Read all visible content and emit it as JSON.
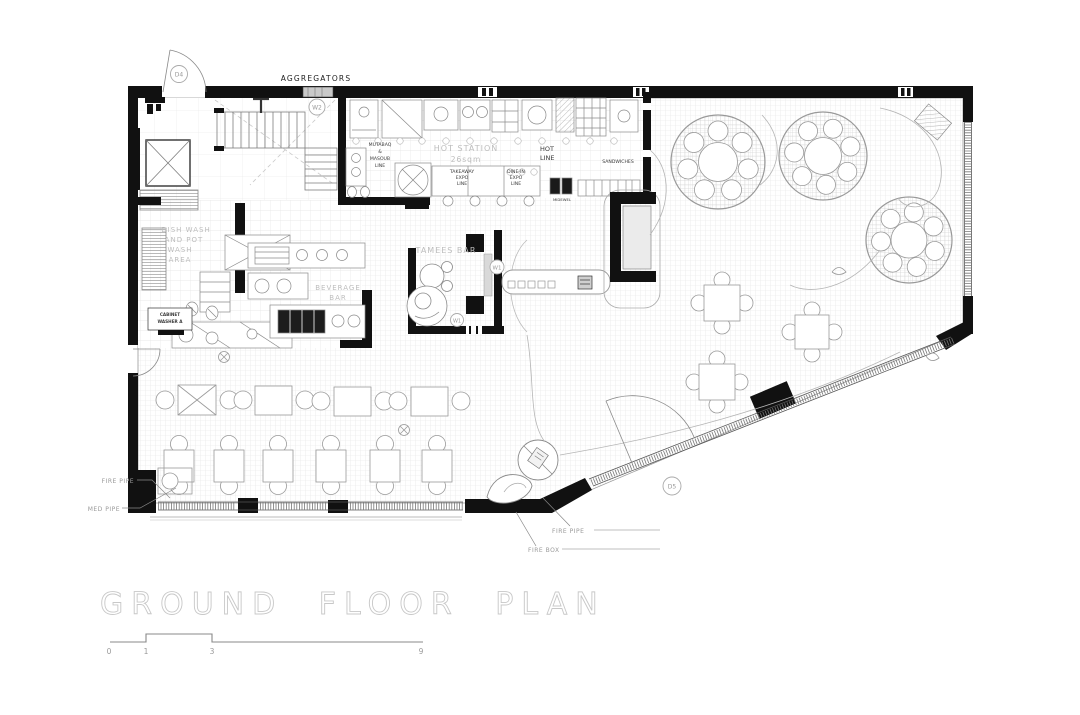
{
  "title": "GROUND FLOOR PLAN",
  "colors": {
    "wall": "#111111",
    "furniture_line": "#8a8a8a",
    "area_label": "#bdbdbd",
    "title_outline": "#c8c8c8",
    "window_gray": "#c9c9c9"
  },
  "labels": {
    "aggregators": "AGGREGATORS",
    "hot_station": "HOT STATION",
    "hot_station_area": "26sqm",
    "hot_line": [
      "HOT",
      "LINE"
    ],
    "takeaway_expo": [
      "TAKEAWAY",
      "EXPO",
      "LINE"
    ],
    "dinein_expo": [
      "DINE-IN",
      "EXPO",
      "LINE"
    ],
    "sandwiches": "SANDWICHES",
    "midewel": "MIDEWEL",
    "mutabaq_line": [
      "MUTABAQ",
      "&",
      "MASOUB",
      "LINE"
    ],
    "tamees_bar": "TAMEES BAR",
    "dish_wash": [
      "DISH WASH",
      "AND POT",
      "WASH",
      "AREA"
    ],
    "beverage_bar": [
      "BEVERAGE",
      "BAR"
    ],
    "cabinet": [
      "CABINET",
      "WASHER A"
    ],
    "fire_pipe_left": "FIRE PIPE",
    "med_pipe": "MED PIPE",
    "fire_pipe_bottom": "FIRE PIPE",
    "fire_box": "FIRE BOX"
  },
  "markers": {
    "d4": "D4",
    "w2": "W2",
    "w1_bar": "W1",
    "w1_tamees": "W1",
    "d5": "D5"
  },
  "scale_bar": {
    "ticks": [
      "0",
      "1",
      "3",
      "9"
    ]
  }
}
